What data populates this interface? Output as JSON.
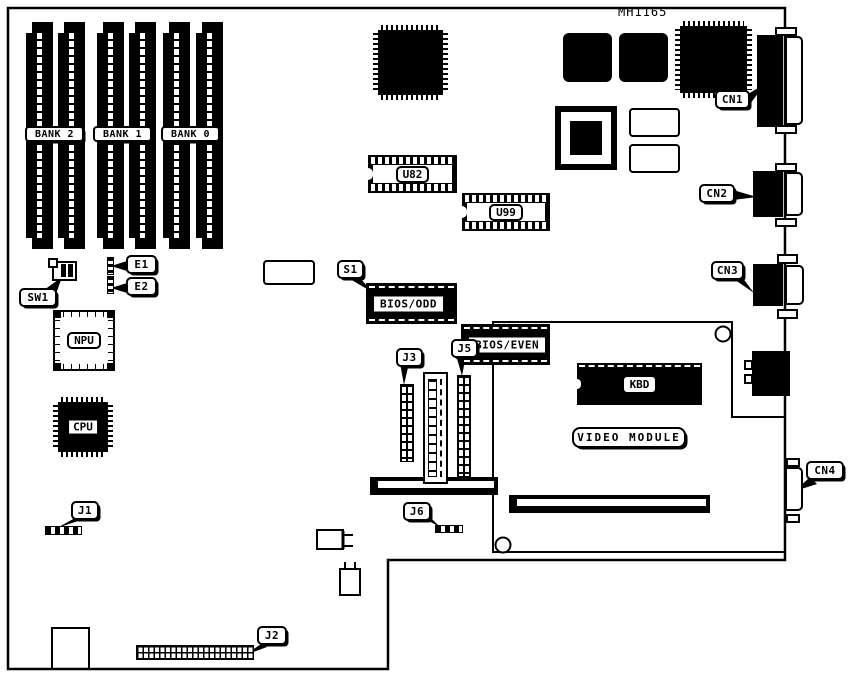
{
  "board": {
    "part_number": "MH1165",
    "memory": {
      "banks": [
        "BANK 2",
        "BANK 1",
        "BANK 0"
      ]
    },
    "chips": {
      "u82": "U82",
      "u99": "U99",
      "bios_odd": "BIOS/ODD",
      "bios_even": "BIOS/EVEN",
      "kbd": "KBD",
      "npu": "NPU",
      "cpu": "CPU",
      "video_module": "VIDEO MODULE"
    },
    "connectors": {
      "cn1": "CN1",
      "cn2": "CN2",
      "cn3": "CN3",
      "cn4": "CN4"
    },
    "switches_jumpers": {
      "sw1": "SW1",
      "e1": "E1",
      "e2": "E2",
      "s1": "S1",
      "j1": "J1",
      "j2": "J2",
      "j3": "J3",
      "j5": "J5",
      "j6": "J6"
    },
    "colors": {
      "ink": "#000000",
      "background": "#ffffff"
    }
  }
}
